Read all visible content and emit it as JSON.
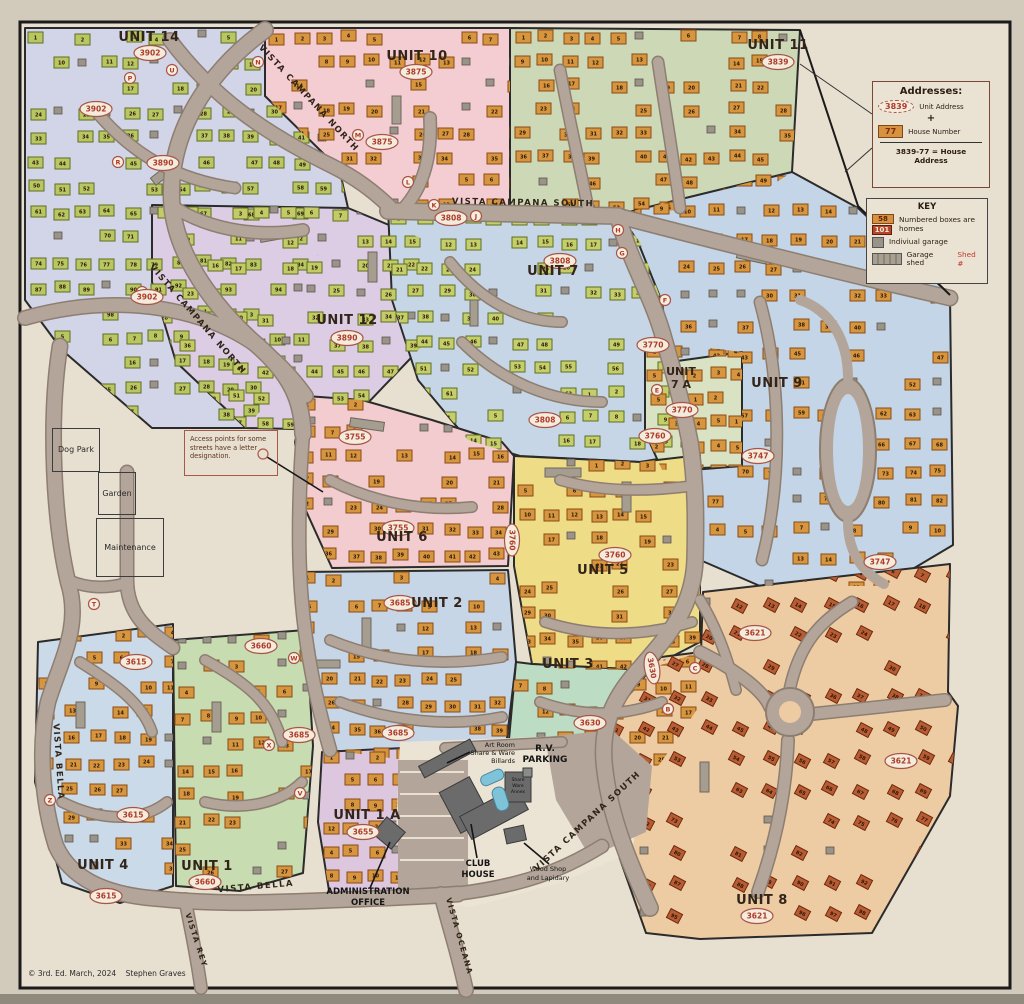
{
  "legend": {
    "addresses": {
      "title": "Addresses:",
      "unit_oval": "3839",
      "unit_label": "Unit Address",
      "plus": "+",
      "house_box": "77",
      "house_label": "House Number",
      "formula": "3839-77 = House Address"
    },
    "key": {
      "title": "KEY",
      "box1": "58",
      "box2": "101",
      "homes_label": "Numbered boxes are homes",
      "garage_label": "Indiviual garage",
      "shed_label": "Garage shed",
      "shed_ref": "Shed #"
    }
  },
  "note": "Access points for some streets have a letter designation.",
  "areas": {
    "dog_park": "Dog Park",
    "garden": "Garden",
    "maintenance": "Maintenance"
  },
  "copyright": "© 3rd. Ed. March, 2024    Stephen Graves",
  "landmarks": {
    "admin": [
      "ADMINISTRATION",
      "OFFICE"
    ],
    "club": [
      "CLUB",
      "HOUSE"
    ],
    "rv": [
      "R.V.",
      "PARKING"
    ],
    "art_room": [
      "Art Room",
      "Share & Ware",
      "Billards"
    ],
    "wood_shop": [
      "Wood Shop",
      "and Lapidary"
    ],
    "annex": [
      "Share",
      "Ware",
      "Annex"
    ]
  },
  "units": [
    {
      "id": "u14",
      "label": "UNIT 14",
      "address": "3902",
      "lx": 149,
      "ly": 41,
      "ox": 150,
      "oy": 53,
      "region": "#d2d4e7",
      "house": "#b9c763",
      "house_border": "#5f6d22",
      "count": 98
    },
    {
      "id": "u12",
      "label": "UNIT 12",
      "address": "3890",
      "lx": 347,
      "ly": 324,
      "ox": 347,
      "oy": 338,
      "region": "#dccde5",
      "house": "#c2cb66",
      "house_border": "#5f6d22",
      "count": 71
    },
    {
      "id": "u10",
      "label": "UNIT 10",
      "address": "3875",
      "lx": 417,
      "ly": 60,
      "ox": 416,
      "oy": 72,
      "region": "#f4cdd2",
      "house": "#d6953f",
      "house_border": "#8a4a15",
      "count": 36
    },
    {
      "id": "u11",
      "label": "UNIT 11",
      "address": "3839",
      "lx": 778,
      "ly": 49,
      "ox": 778,
      "oy": 62,
      "region": "#cdd8b6",
      "house": "#d6953f",
      "house_border": "#8a4a15",
      "count": 77
    },
    {
      "id": "u7",
      "label": "UNIT 7",
      "address": "3808",
      "lx": 553,
      "ly": 275,
      "ox": 560,
      "oy": 261,
      "region": "#c6d6e7",
      "house": "#c4cf6a",
      "house_border": "#5f6d22",
      "count": 62
    },
    {
      "id": "u7a",
      "label": "UNIT 7 A",
      "label_lines": [
        "UNIT",
        "7 A"
      ],
      "address": "3770",
      "lx": 681,
      "ly": 375,
      "ox": 682,
      "oy": 410,
      "region": "#d9e3c4",
      "house": "#d6953f",
      "house_border": "#8a4a15",
      "count": 5
    },
    {
      "id": "u9",
      "label": "UNIT 9",
      "address": "3747",
      "lx": 777,
      "ly": 387,
      "ox": 758,
      "oy": 456,
      "region": "#c3d5e6",
      "house": "#d6953f",
      "house_border": "#8a4a15",
      "count": 82
    },
    {
      "id": "u6",
      "label": "UNIT 6",
      "address": "3755",
      "lx": 402,
      "ly": 541,
      "ox": 398,
      "oy": 528,
      "region": "#f2cccf",
      "house": "#d6953f",
      "house_border": "#8a4a15",
      "count": 65
    },
    {
      "id": "u5",
      "label": "UNIT 5",
      "address": "3760",
      "lx": 603,
      "ly": 574,
      "ox": 615,
      "oy": 555,
      "region": "#eedc87",
      "house": "#d6953f",
      "house_border": "#8a4a15",
      "count": 82
    },
    {
      "id": "u2",
      "label": "UNIT 2",
      "address": "3685",
      "lx": 437,
      "ly": 607,
      "ox": 400,
      "oy": 603,
      "region": "#c6d6e7",
      "house": "#d6953f",
      "house_border": "#8a4a15",
      "count": 74
    },
    {
      "id": "u3",
      "label": "UNIT 3",
      "address": "3630",
      "lx": 568,
      "ly": 668,
      "ox": 590,
      "oy": 723,
      "region": "#bcdcc4",
      "house": "#d6953f",
      "house_border": "#8a4a15",
      "count": 43
    },
    {
      "id": "u1",
      "label": "UNIT 1",
      "address": "3660",
      "lx": 207,
      "ly": 870,
      "ox": 205,
      "oy": 882,
      "region": "#c7dcb0",
      "house": "#d6953f",
      "house_border": "#8a4a15",
      "count": 51
    },
    {
      "id": "u4",
      "label": "UNIT 4",
      "address": "3615",
      "lx": 103,
      "ly": 869,
      "ox": 106,
      "oy": 896,
      "region": "#cbdae9",
      "house": "#d6953f",
      "house_border": "#8a4a15",
      "count": 46
    },
    {
      "id": "u1a",
      "label": "UNIT 1 A",
      "address": "3655",
      "lx": 367,
      "ly": 819,
      "ox": 363,
      "oy": 832,
      "region": "#dcc7df",
      "house": "#d6953f",
      "house_border": "#8a4a15",
      "count": 12
    },
    {
      "id": "u8",
      "label": "UNIT 8",
      "address": "3621",
      "lx": 762,
      "ly": 904,
      "ox": 757,
      "oy": 916,
      "region": "#edcba3",
      "house": "#b85c34",
      "house_border": "#6e2a0e",
      "count": 120
    }
  ],
  "extra_ovals": [
    {
      "t": "3902",
      "x": 96,
      "y": 109
    },
    {
      "t": "3902",
      "x": 147,
      "y": 297
    },
    {
      "t": "3875",
      "x": 382,
      "y": 142
    },
    {
      "t": "3890",
      "x": 163,
      "y": 163
    },
    {
      "t": "3808",
      "x": 451,
      "y": 218
    },
    {
      "t": "3808",
      "x": 545,
      "y": 420
    },
    {
      "t": "3770",
      "x": 653,
      "y": 345
    },
    {
      "t": "3747",
      "x": 880,
      "y": 562
    },
    {
      "t": "3755",
      "x": 355,
      "y": 437
    },
    {
      "t": "3760",
      "x": 512,
      "y": 540,
      "r": 90
    },
    {
      "t": "3760",
      "x": 655,
      "y": 436
    },
    {
      "t": "3685",
      "x": 398,
      "y": 733
    },
    {
      "t": "3685",
      "x": 299,
      "y": 735
    },
    {
      "t": "3630",
      "x": 652,
      "y": 668,
      "r": 80
    },
    {
      "t": "3660",
      "x": 261,
      "y": 646
    },
    {
      "t": "3615",
      "x": 136,
      "y": 662
    },
    {
      "t": "3615",
      "x": 133,
      "y": 815
    },
    {
      "t": "3621",
      "x": 755,
      "y": 633
    },
    {
      "t": "3621",
      "x": 901,
      "y": 761
    }
  ],
  "access_points": [
    {
      "l": "P",
      "x": 130,
      "y": 78
    },
    {
      "l": "U",
      "x": 172,
      "y": 70
    },
    {
      "l": "N",
      "x": 258,
      "y": 62
    },
    {
      "l": "R",
      "x": 118,
      "y": 162
    },
    {
      "l": "S",
      "x": 142,
      "y": 292
    },
    {
      "l": "M",
      "x": 358,
      "y": 135
    },
    {
      "l": "L",
      "x": 408,
      "y": 182
    },
    {
      "l": "K",
      "x": 434,
      "y": 205
    },
    {
      "l": "J",
      "x": 476,
      "y": 216
    },
    {
      "l": "H",
      "x": 618,
      "y": 230
    },
    {
      "l": "G",
      "x": 622,
      "y": 253
    },
    {
      "l": "F",
      "x": 665,
      "y": 300
    },
    {
      "l": "E",
      "x": 657,
      "y": 390
    },
    {
      "l": "C",
      "x": 695,
      "y": 668
    },
    {
      "l": "B",
      "x": 668,
      "y": 709
    },
    {
      "l": "W",
      "x": 294,
      "y": 658
    },
    {
      "l": "X",
      "x": 269,
      "y": 745
    },
    {
      "l": "V",
      "x": 300,
      "y": 793
    },
    {
      "l": "Z",
      "x": 50,
      "y": 800
    },
    {
      "l": "T",
      "x": 94,
      "y": 604
    }
  ],
  "streets": [
    {
      "n": "VISTA CAMPANA NORTH",
      "x": 307,
      "y": 100,
      "r": 47
    },
    {
      "n": "VISTA CAMPANA NORTH",
      "x": 196,
      "y": 321,
      "r": 49
    },
    {
      "n": "VISTA CAMPANA SOUTH",
      "x": 523,
      "y": 205,
      "r": 1
    },
    {
      "n": "VISTA CAMPANA SOUTH",
      "x": 589,
      "y": 823,
      "r": -43
    },
    {
      "n": "VISTA BELLA",
      "x": 56,
      "y": 762,
      "r": 86
    },
    {
      "n": "VISTA BELLA",
      "x": 256,
      "y": 889,
      "r": -5
    },
    {
      "n": "VISTA REY",
      "x": 194,
      "y": 941,
      "r": 72,
      "s": 7.5
    },
    {
      "n": "VISTA OCEANA",
      "x": 457,
      "y": 937,
      "r": 74,
      "s": 7.5
    }
  ],
  "colors": {
    "paper": "#e7dfcf",
    "road": "#b3a599",
    "road_edge": "#8d7e71",
    "frame": "#1b1b1b",
    "oval_stroke": "#a85548",
    "oval_text": "#b03a2a"
  }
}
